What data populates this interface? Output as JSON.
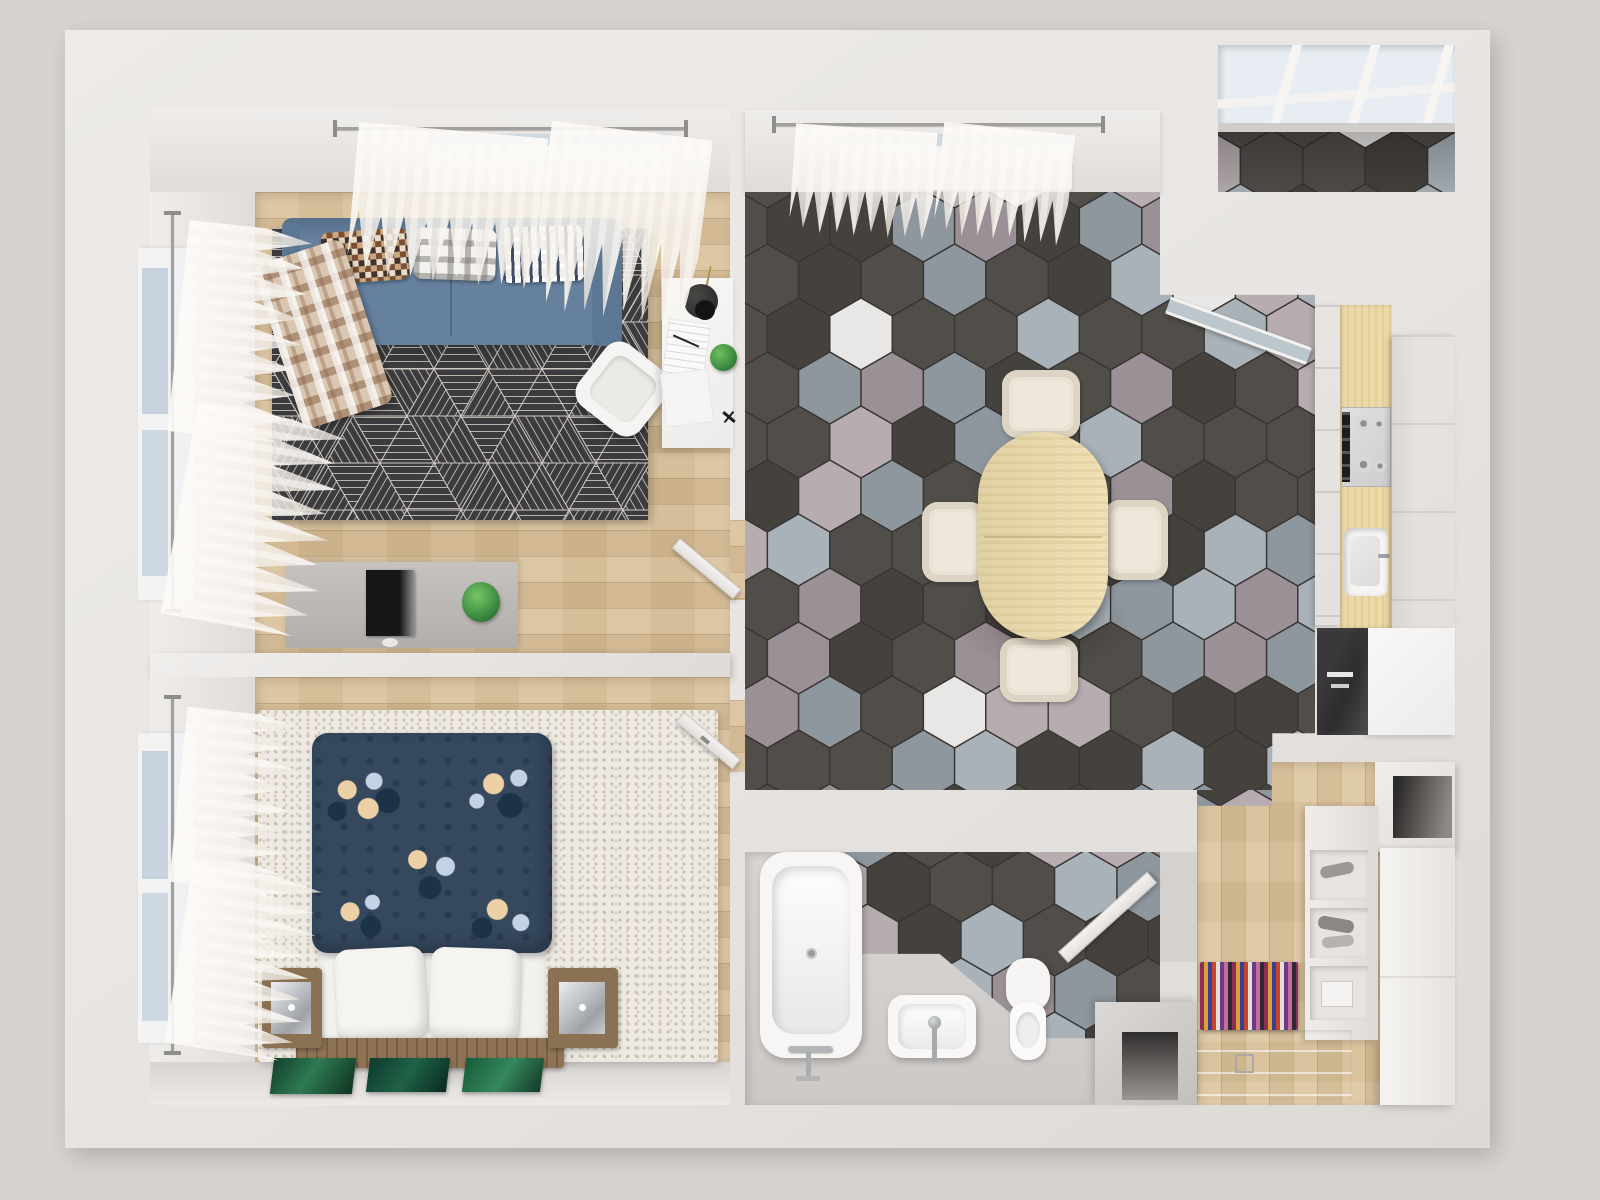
{
  "title": "Top-view 3D render of a one-bedroom apartment floor plan",
  "palette": {
    "bg": "#d7d3d1",
    "wall": "#e9e6e3",
    "wood": "#d8bf97",
    "hall_wood": "#dcc49c",
    "pebble": "#eeeae3",
    "hex_grout": "#383532",
    "hex_tiles": [
      "#514d49",
      "#45423e",
      "#8e969e",
      "#9b9095",
      "#b7adb0",
      "#e9e7e5",
      "#a9b2b9"
    ],
    "hex_weights": [
      30,
      16,
      13,
      10,
      8,
      8,
      15
    ],
    "rug_base": "#3c3b3d",
    "rug_line": "#cfc9c1",
    "sofa_blue": "#66819e",
    "sofa_blue_dark": "#5c7794",
    "duvet_navy": "#35485e",
    "duvet_dot": "#2b3c50",
    "flower_cream": "#ecd0a6",
    "flower_blue": "#c3d2e4",
    "leaf_dark": "#1c3246",
    "table_wood": "#eedfb0",
    "chair_cream": "#e9e2d5",
    "counter_wood": "#ecd9a8",
    "stove_steel": "#cdcdcd",
    "dark_cabinet": "#2e2c2e",
    "plant_green": "#3f9144",
    "art_green_a": "#14402e",
    "art_green_b": "#2e7a52",
    "tub_white": "#f7f6f5",
    "niche_dark": "#2f2d2c",
    "hall_rug_stripes": [
      "#8c2f52",
      "#d8a13a",
      "#3c3f8f",
      "#c5452f",
      "#e3e0da",
      "#6b3c8c",
      "#c96a9b",
      "#2b2b33"
    ]
  },
  "scene": {
    "rooms": {
      "living": {
        "name": "Living room",
        "furniture": [
          "blue sofa",
          "mosaic pillow",
          "gingham pillow",
          "striped pillow",
          "plaid throw",
          "triangle-pattern rug",
          "white armchair",
          "white desk",
          "desk lamp",
          "desk plant",
          "TV console",
          "TV",
          "potted plant",
          "open door"
        ]
      },
      "bedroom": {
        "name": "Bedroom",
        "furniture": [
          "double bed",
          "floral navy duvet",
          "two white pillows",
          "wood headboard",
          "left nightstand",
          "right nightstand",
          "pebble rug",
          "three green artworks",
          "open door"
        ]
      },
      "dining": {
        "name": "Dining room / kitchen",
        "furniture": [
          "oval dining table",
          "four cream chairs",
          "hexagon tile floor",
          "kitchen counter",
          "gas stove",
          "kitchen sink",
          "fridge cabinet",
          "dark display cabinet",
          "glazed door"
        ]
      },
      "bathroom": {
        "name": "Bathroom",
        "furniture": [
          "bathtub",
          "washbasin",
          "toilet",
          "hex tile band",
          "open door"
        ]
      },
      "hallway": {
        "name": "Entry hall",
        "furniture": [
          "wardrobe",
          "shoe shelf",
          "striped rug",
          "entry mat",
          "door niche"
        ]
      },
      "balcony": {
        "name": "Balcony",
        "furniture": [
          "skylight glazing",
          "hex tile floor"
        ]
      }
    },
    "windows": [
      "living room top window",
      "living room left window",
      "bedroom left window",
      "dining room top window"
    ],
    "curtains_count": 8
  }
}
